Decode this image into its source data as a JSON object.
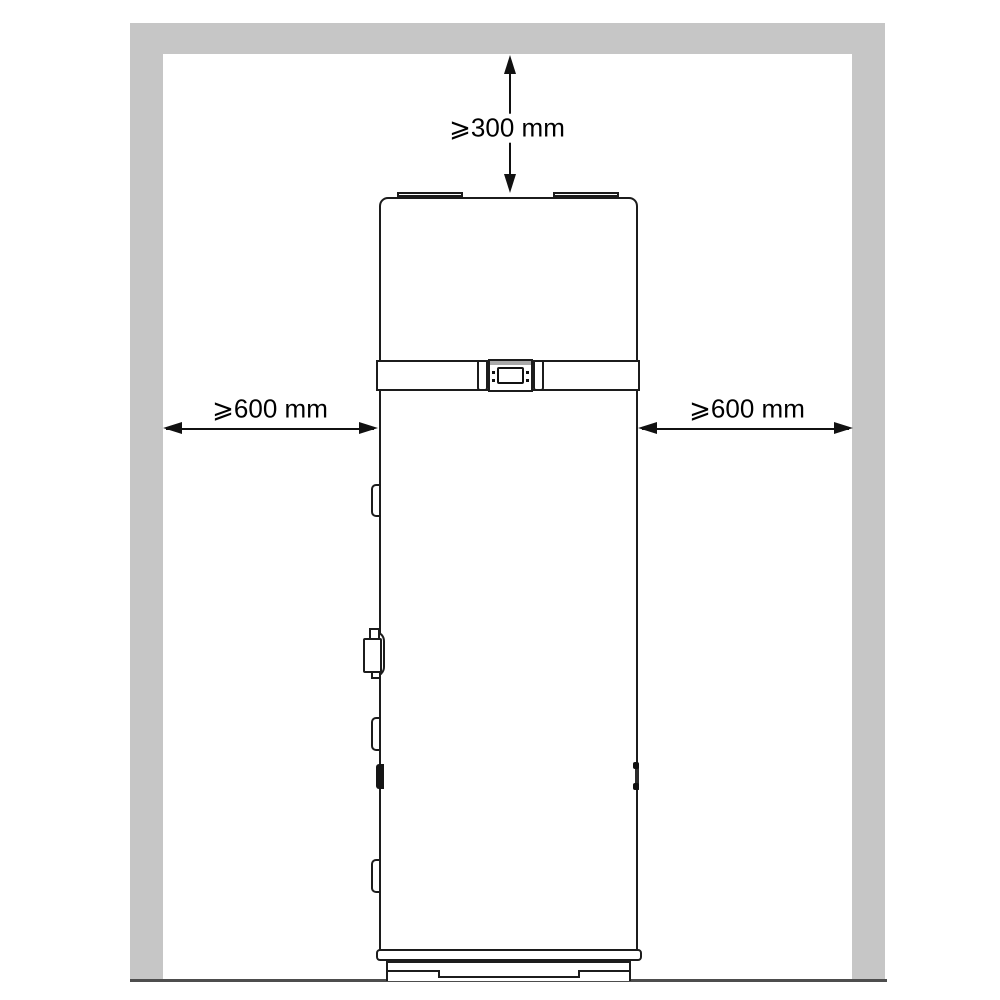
{
  "diagram": {
    "labels": {
      "top_clearance": "⩾300 mm",
      "left_clearance": "⩾600 mm",
      "right_clearance": "⩾600 mm"
    },
    "colors": {
      "wall": "#c6c6c6",
      "floor_line": "#4d4d4d",
      "outline": "#1c1c1c",
      "text": "#000000",
      "background": "#ffffff"
    },
    "icons": {
      "vertical_dimension": "double-arrow-vertical-icon",
      "left_dimension": "double-arrow-horizontal-icon",
      "right_dimension": "double-arrow-horizontal-icon"
    }
  }
}
